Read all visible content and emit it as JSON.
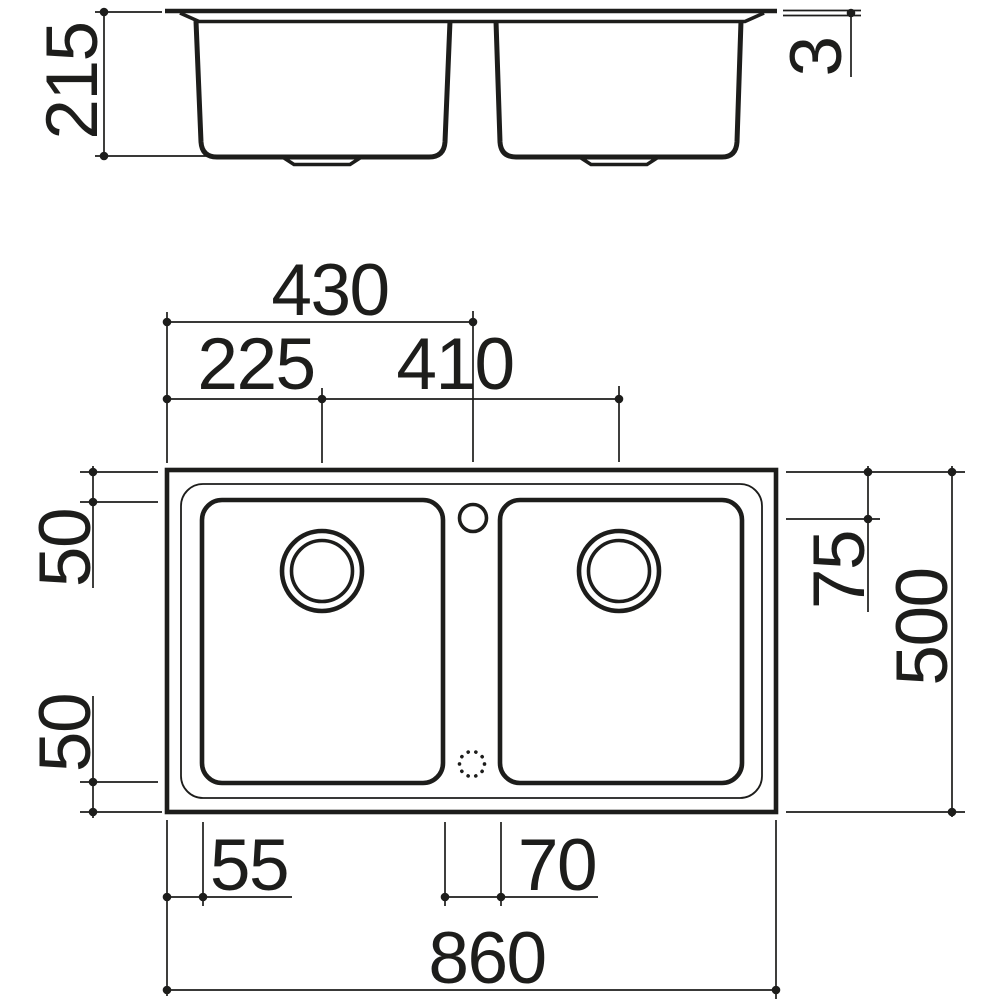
{
  "drawing": {
    "subject": "double-bowl inset sink technical drawing",
    "views": {
      "front_elevation": "front elevation view",
      "plan": "top plan view"
    },
    "colors": {
      "line": "#1d1d1b",
      "background": "#ffffff"
    },
    "dimensions": {
      "front": {
        "bowl_depth": "215",
        "rim_thickness": "3"
      },
      "plan_top": {
        "centre_from_left": "430",
        "drain_from_left": "225",
        "drain_spacing": "410"
      },
      "plan_left": {
        "top_edge_to_bowl": "50",
        "bowl_to_bottom_edge": "50"
      },
      "plan_right": {
        "edge_to_tap_axis": "75",
        "overall_depth": "500"
      },
      "plan_bottom": {
        "edge_to_bowl": "55",
        "bowl_divider": "70",
        "overall_width": "860"
      }
    }
  }
}
